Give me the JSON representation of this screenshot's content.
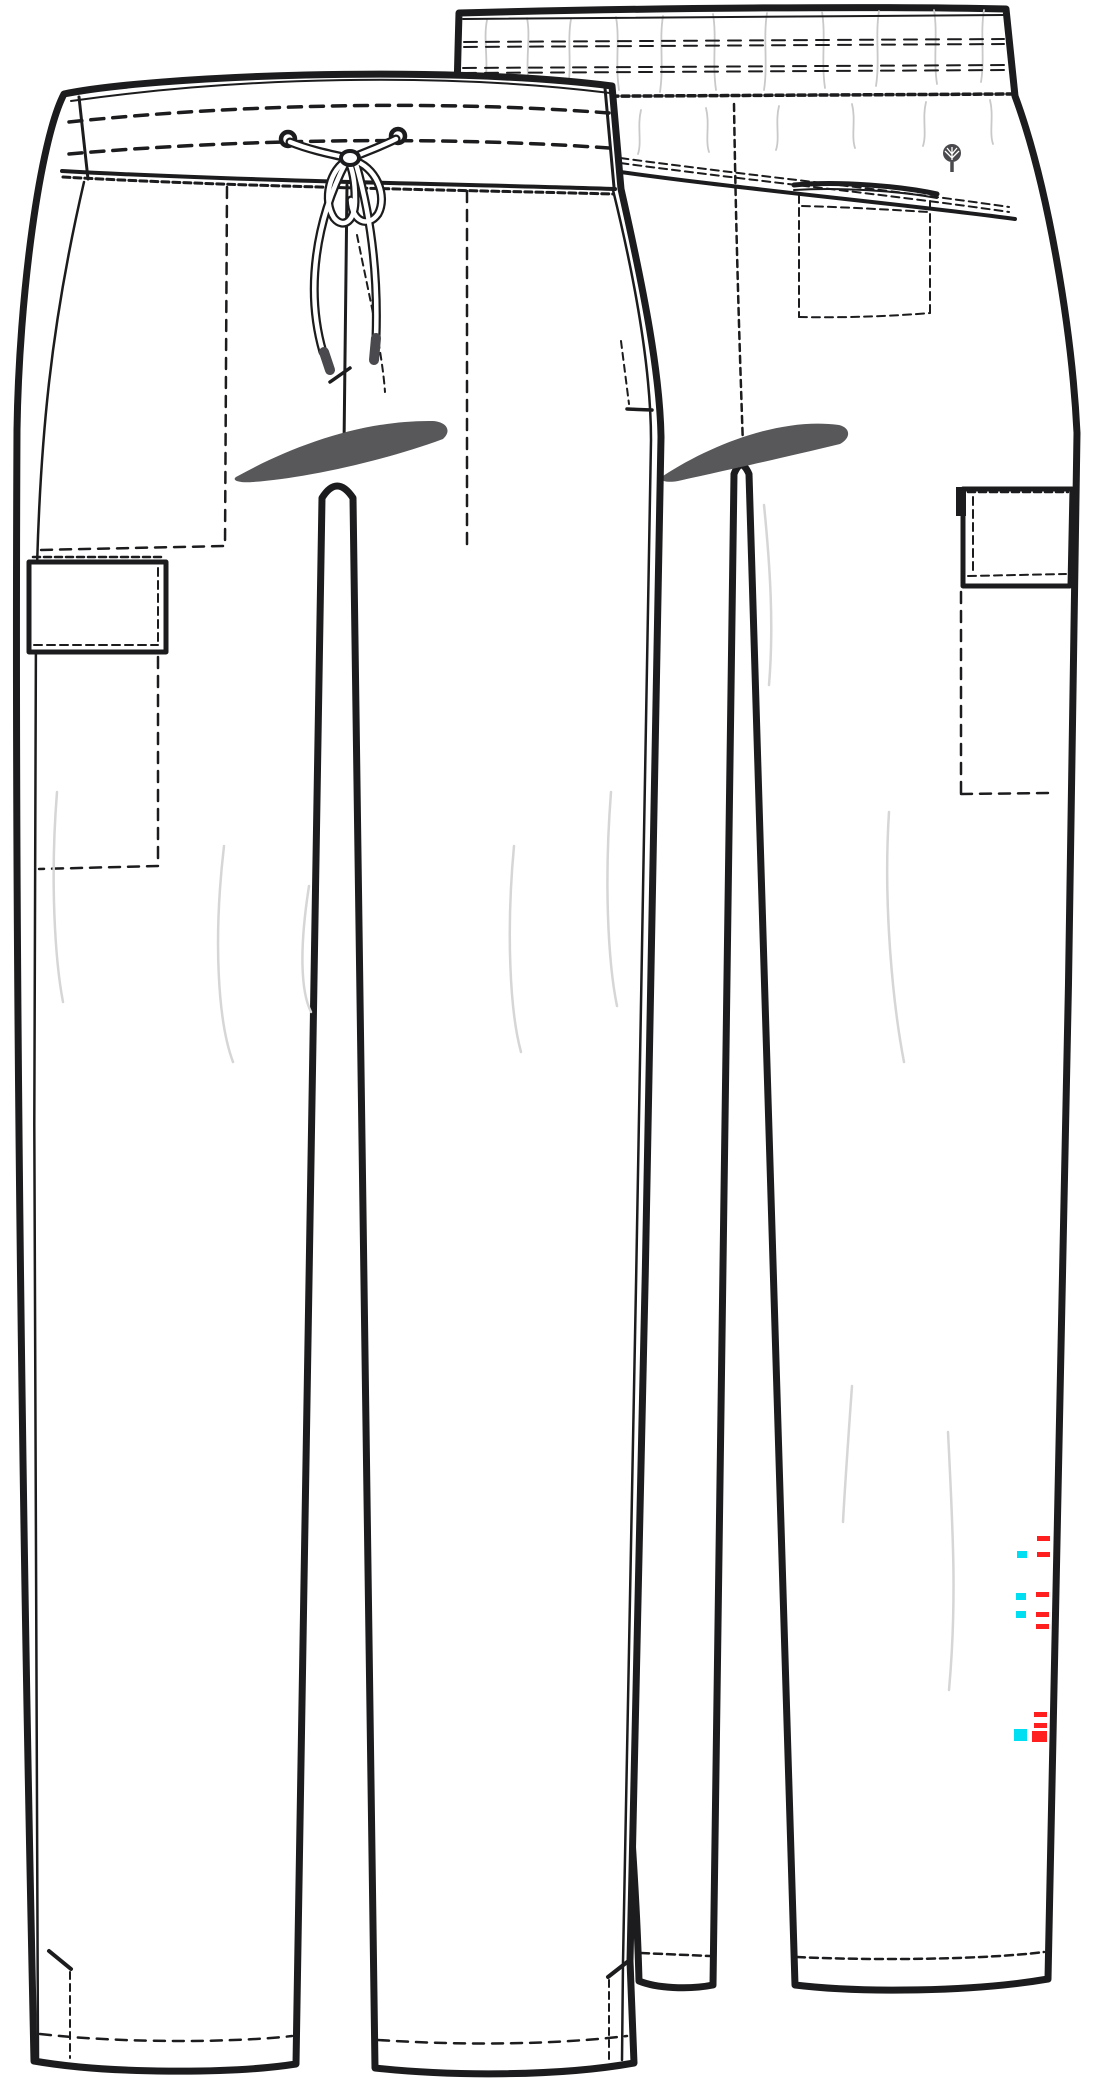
{
  "figure": {
    "kind": "garment-technical-flat-sketch",
    "description": "Technical flat sketch of drawstring cargo scrub pants, front view and back view, black line art on white",
    "views": [
      {
        "name": "front-view",
        "components": [
          "contrast waistband with two topstitch rows",
          "drawstring with bow, grommets and aglets",
          "center-front seam",
          "slash pocket bag lines",
          "left cargo pocket",
          "crotch shadow",
          "side vents at hem",
          "hem topstitching"
        ]
      },
      {
        "name": "back-view",
        "components": [
          "knit waistband with wrinkle texture and double topstitch rows",
          "curved back yoke seam",
          "brand tree logo on waistband",
          "back patch pocket",
          "right cargo pocket with bag lines",
          "center-back seam",
          "crotch shadow",
          "hem topstitching"
        ]
      }
    ]
  },
  "colors": {
    "background": "#ffffff",
    "line": "#1c1c1e",
    "shadow": "#58585b",
    "wrinkle": "#d6d6d6",
    "texture": "#c9c9c9",
    "red_mark": "#ff1f1f",
    "cyan_mark": "#00dff2",
    "aglet": "#4a4a4e"
  },
  "grading_marks": {
    "red": [
      {
        "x": 1037,
        "y": 1536,
        "w": 13,
        "h": 5
      },
      {
        "x": 1037,
        "y": 1552,
        "w": 13,
        "h": 5
      },
      {
        "x": 1036,
        "y": 1592,
        "w": 13,
        "h": 5
      },
      {
        "x": 1036,
        "y": 1612,
        "w": 13,
        "h": 5
      },
      {
        "x": 1036,
        "y": 1624,
        "w": 13,
        "h": 5
      },
      {
        "x": 1034,
        "y": 1712,
        "w": 13,
        "h": 5
      },
      {
        "x": 1034,
        "y": 1723,
        "w": 13,
        "h": 5
      },
      {
        "x": 1032,
        "y": 1731,
        "w": 15,
        "h": 11
      }
    ],
    "cyan": [
      {
        "x": 1017,
        "y": 1551,
        "w": 10,
        "h": 7
      },
      {
        "x": 1016,
        "y": 1593,
        "w": 10,
        "h": 7
      },
      {
        "x": 1016,
        "y": 1611,
        "w": 10,
        "h": 7
      },
      {
        "x": 1014,
        "y": 1729,
        "w": 13,
        "h": 12
      }
    ]
  }
}
